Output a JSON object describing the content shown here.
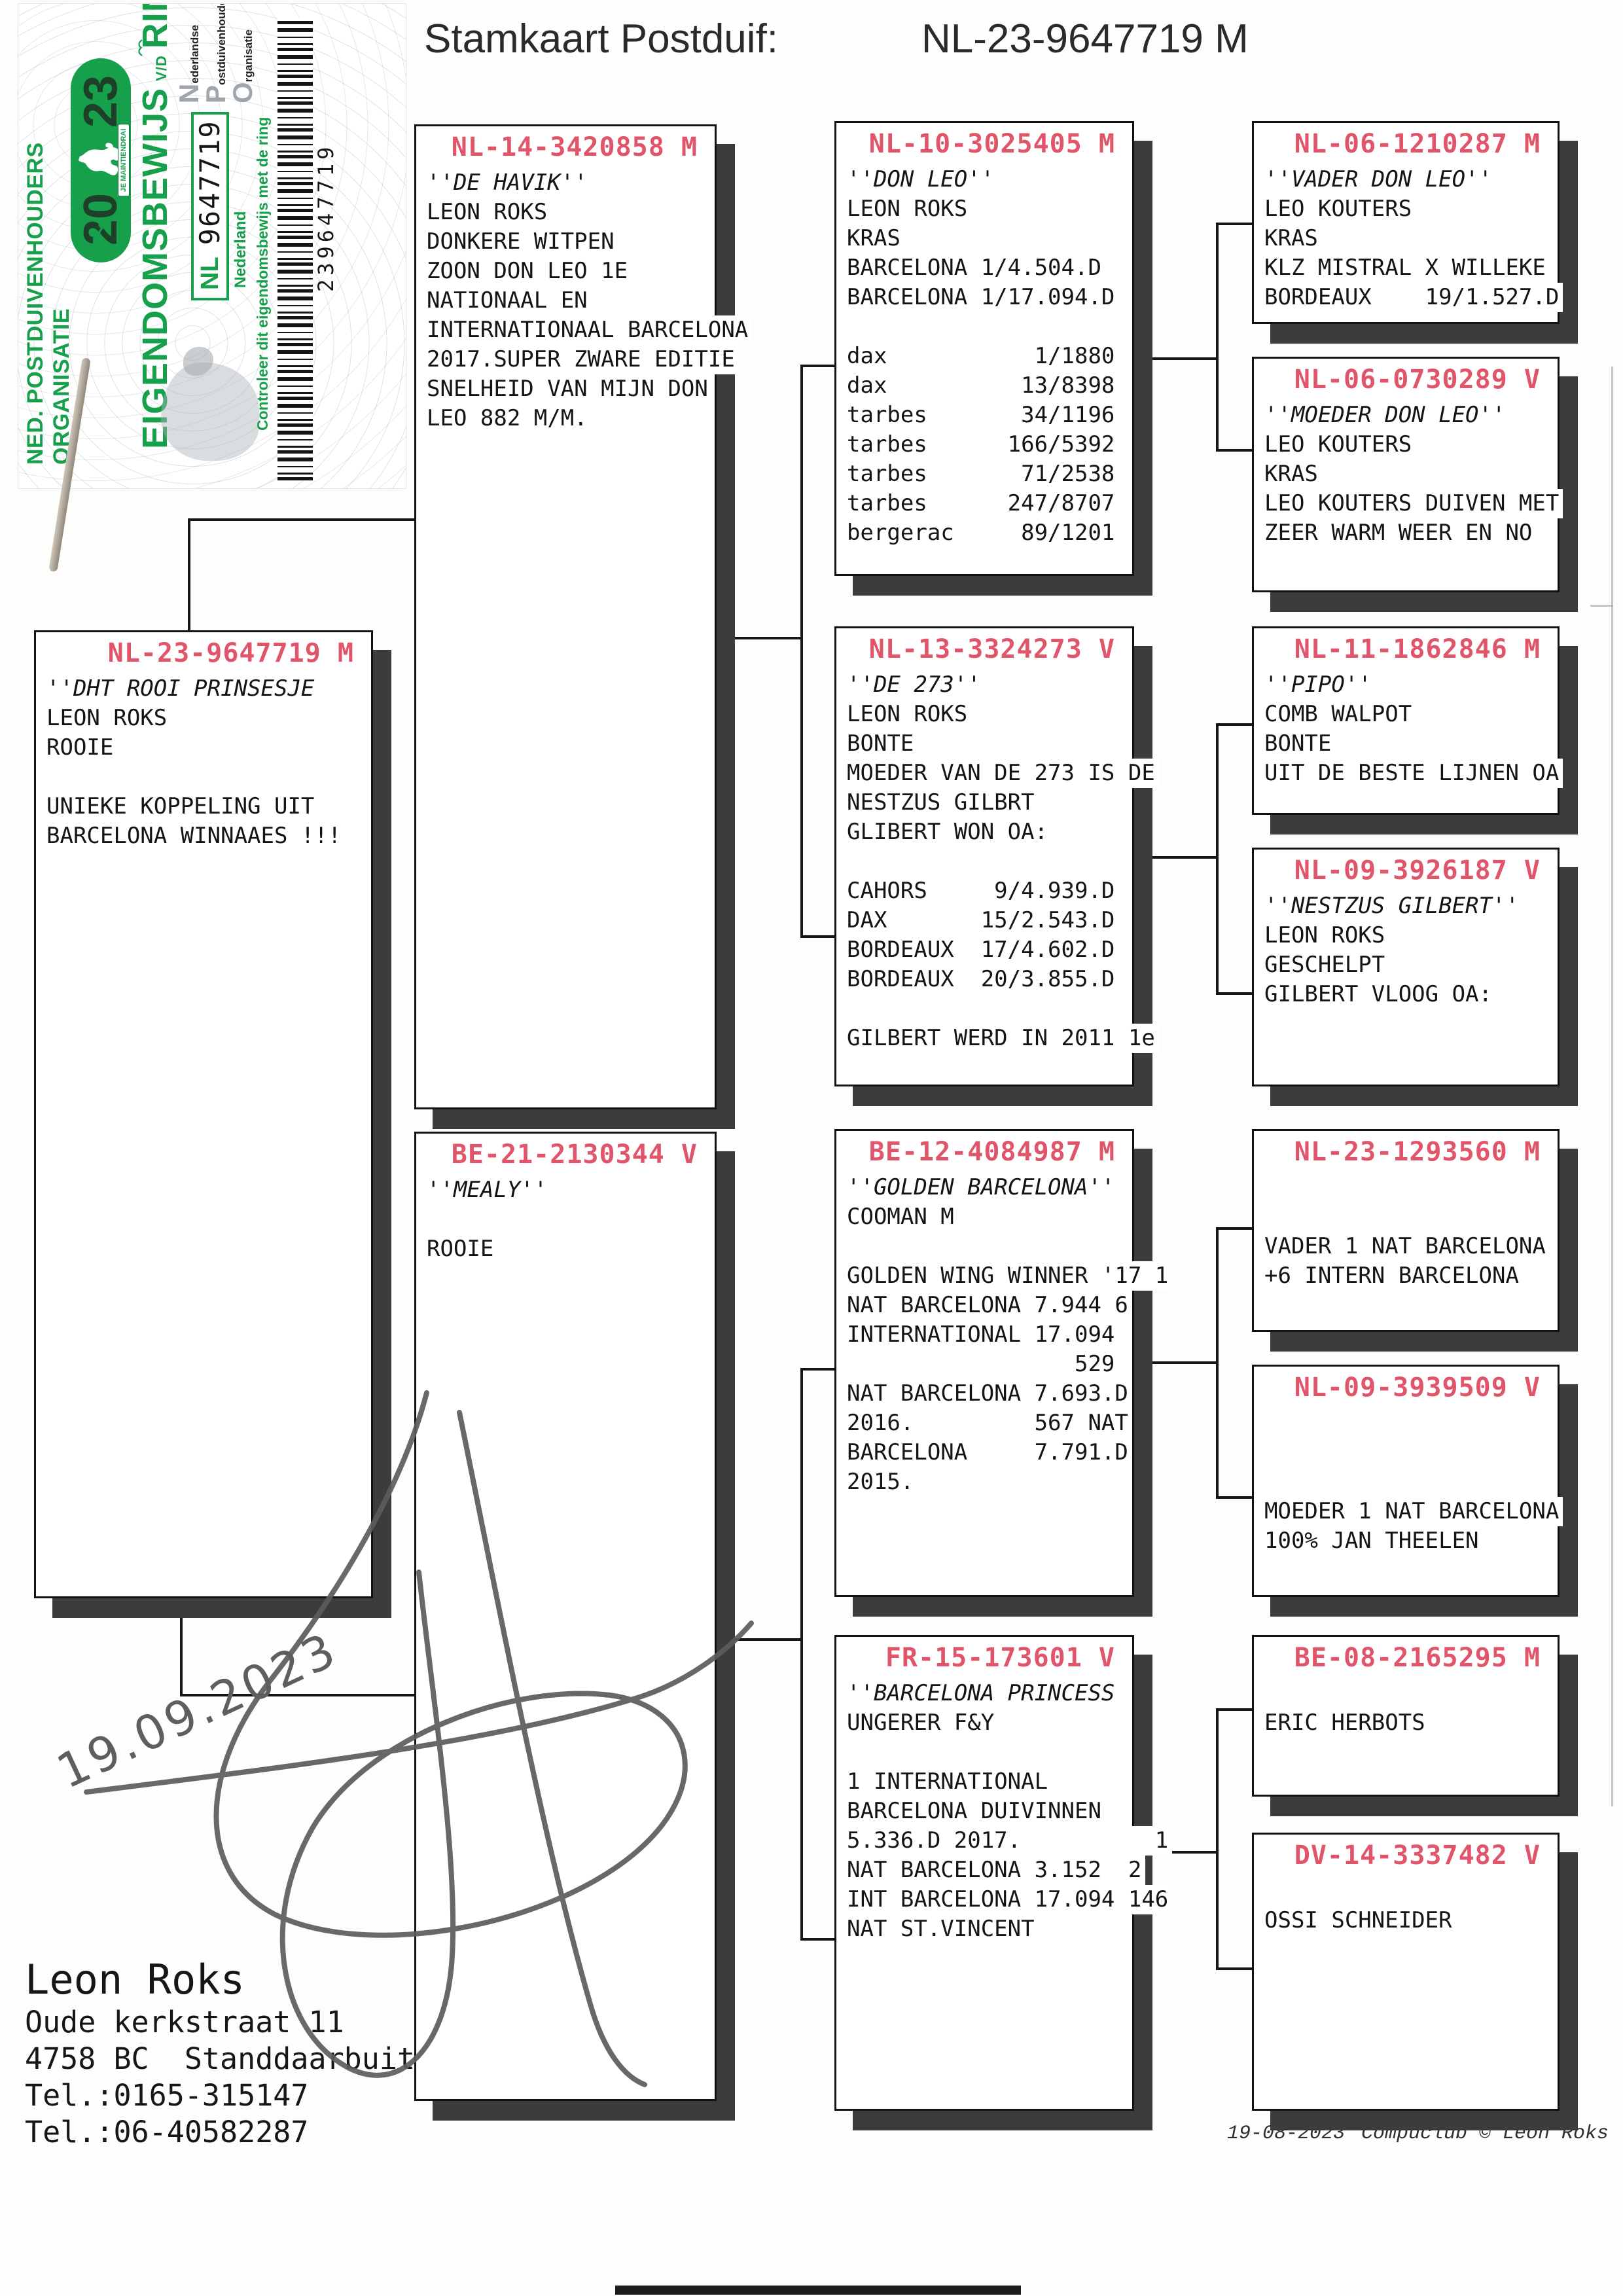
{
  "title": {
    "label": "Stamkaart Postduif:",
    "ring": "NL-23-9647719 M"
  },
  "sticker": {
    "org_line": "NED. POSTDUIVENHOUDERS ORGANISATIE",
    "year_left": "20",
    "year_right": "23",
    "motto": "JE MAINTIENDRAI",
    "ownership_word": "EIGENDOMSBEWIJS",
    "vd": "V/D",
    "ring_word": "RING",
    "npo": [
      {
        "initial": "N",
        "rest": "ederlandse"
      },
      {
        "initial": "P",
        "rest": "ostduivenhouders"
      },
      {
        "initial": "O",
        "rest": "rganisatie"
      }
    ],
    "ring_country": "NL",
    "ring_number": "9647719",
    "country_label": "Nederland",
    "check_line": "Controleer dit eigendomsbewijs met de ring",
    "barcode_number": "239647719"
  },
  "boxes": [
    {
      "ring": "NL-23-9647719 M",
      "lines": [
        "''DHT ROOI PRINSESJE",
        "LEON ROKS",
        "ROOIE",
        "",
        "UNIEKE KOPPELING UIT",
        "BARCELONA WINNAAES !!!"
      ]
    },
    {
      "ring": "NL-14-3420858 M",
      "lines": [
        "''DE HAVIK''",
        "LEON ROKS",
        "DONKERE WITPEN",
        "ZOON DON LEO 1E",
        "NATIONAAL EN",
        "INTERNATIONAAL BARCELONA",
        "2017.SUPER ZWARE EDITIE",
        "SNELHEID VAN MIJN DON",
        "LEO 882 M/M."
      ]
    },
    {
      "ring": "BE-21-2130344 V",
      "lines": [
        "''MEALY''",
        "",
        "ROOIE"
      ]
    },
    {
      "ring": "NL-10-3025405 M",
      "lines": [
        "''DON LEO''",
        "LEON ROKS",
        "KRAS",
        "BARCELONA 1/4.504.D",
        "BARCELONA 1/17.094.D",
        "",
        "dax           1/1880",
        "dax          13/8398",
        "tarbes       34/1196",
        "tarbes      166/5392",
        "tarbes       71/2538",
        "tarbes      247/8707",
        "bergerac     89/1201"
      ]
    },
    {
      "ring": "NL-13-3324273 V",
      "lines": [
        "''DE 273''",
        "LEON ROKS",
        "BONTE",
        "MOEDER VAN DE 273 IS DE",
        "NESTZUS GILBRT",
        "GLIBERT WON OA:",
        "",
        "CAHORS     9/4.939.D",
        "DAX       15/2.543.D",
        "BORDEAUX  17/4.602.D",
        "BORDEAUX  20/3.855.D",
        "",
        "GILBERT WERD IN 2011 1e"
      ]
    },
    {
      "ring": "BE-12-4084987 M",
      "lines": [
        "''GOLDEN BARCELONA''",
        "COOMAN M",
        "",
        "GOLDEN WING WINNER '17 1",
        "NAT BARCELONA 7.944 6",
        "INTERNATIONAL 17.094",
        "                 529",
        "NAT BARCELONA 7.693.D",
        "2016.         567 NAT",
        "BARCELONA     7.791.D",
        "2015."
      ]
    },
    {
      "ring": "FR-15-173601 V",
      "lines": [
        "''BARCELONA PRINCESS",
        "UNGERER F&Y",
        "",
        "1 INTERNATIONAL",
        "BARCELONA DUIVINNEN",
        "5.336.D 2017.          1",
        "NAT BARCELONA 3.152  2",
        "INT BARCELONA 17.094 146",
        "NAT ST.VINCENT"
      ]
    },
    {
      "ring": "NL-06-1210287 M",
      "lines": [
        "''VADER DON LEO''",
        "LEO KOUTERS",
        "KRAS",
        "KLZ MISTRAL X WILLEKE",
        "BORDEAUX    19/1.527.D"
      ]
    },
    {
      "ring": "NL-06-0730289 V",
      "lines": [
        "''MOEDER DON LEO''",
        "LEO KOUTERS",
        "KRAS",
        "LEO KOUTERS DUIVEN MET",
        "ZEER WARM WEER EN NO"
      ]
    },
    {
      "ring": "NL-11-1862846 M",
      "lines": [
        "''PIPO''",
        "COMB WALPOT",
        "BONTE",
        "UIT DE BESTE LIJNEN OA"
      ]
    },
    {
      "ring": "NL-09-3926187 V",
      "lines": [
        "''NESTZUS GILBERT''",
        "LEON ROKS",
        "GESCHELPT",
        "GILBERT VLOOG OA:"
      ]
    },
    {
      "ring": "NL-23-1293560 M",
      "lines": [
        "",
        "",
        "VADER 1 NAT BARCELONA",
        "+6 INTERN BARCELONA"
      ]
    },
    {
      "ring": "NL-09-3939509 V",
      "lines": [
        "",
        "",
        "",
        "MOEDER 1 NAT BARCELONA",
        "100% JAN THEELEN"
      ]
    },
    {
      "ring": "BE-08-2165295 M",
      "lines": [
        "",
        "ERIC HERBOTS"
      ]
    },
    {
      "ring": "DV-14-3337482 V",
      "lines": [
        "",
        "OSSI SCHNEIDER"
      ]
    }
  ],
  "owner": {
    "name": "Leon Roks",
    "address1": "Oude kerkstraat 11",
    "address2": "4758 BC  Standdaarbuiten",
    "tel1": "Tel.:0165-315147",
    "tel2": "Tel.:06-40582287"
  },
  "footer": {
    "date": "19-08-2023",
    "credit": "Compuclub © Leon Roks"
  },
  "signature_date": "19.09.2023",
  "colors": {
    "header_red": "#e0556a",
    "green": "#17a04c",
    "shadow": "#3c3c3c"
  }
}
